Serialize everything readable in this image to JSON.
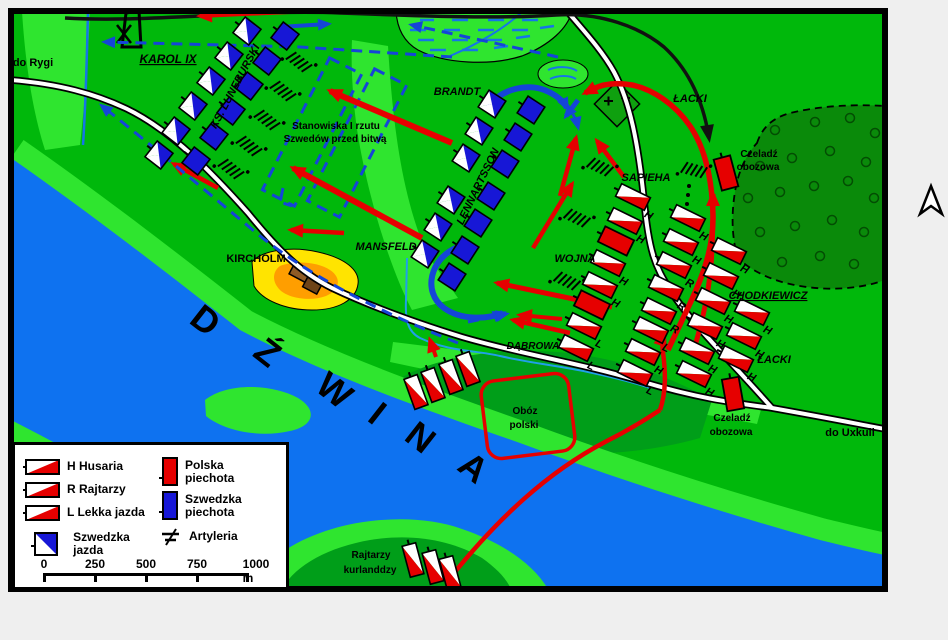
{
  "colors": {
    "land": "#00B80B",
    "land_light": "#2FE52F",
    "land_medium": "#009E19",
    "forest": "#0A8A0A",
    "river": "#0E72F0",
    "polish_red": "#E60000",
    "swedish_blue": "#1717D6",
    "arrow_blue": "#1545D8",
    "hill_yellow": "#FFE400",
    "hill_orange": "#FF9E00",
    "building_brown": "#8F5B25"
  },
  "map_labels": [
    {
      "id": "do-rygi",
      "text": "do Rygi",
      "x": 33,
      "y": 66,
      "size": 11
    },
    {
      "id": "karol-ix",
      "text": "KAROL IX",
      "x": 168,
      "y": 63,
      "size": 12,
      "italic": true,
      "underline": true
    },
    {
      "id": "ks-luneburski",
      "text": "KS. LUNEBURSKI",
      "x": 238,
      "y": 88,
      "size": 11,
      "italic": true,
      "rot": -62
    },
    {
      "id": "brandt",
      "text": "BRANDT",
      "x": 457,
      "y": 95,
      "size": 11,
      "italic": true
    },
    {
      "id": "stanowiska-1",
      "text": "Stanowiska I rzutu",
      "x": 336,
      "y": 129,
      "size": 10
    },
    {
      "id": "stanowiska-2",
      "text": "Szwedów przed bitwą",
      "x": 335,
      "y": 142,
      "size": 10
    },
    {
      "id": "lennartsson",
      "text": "LENNARTSSON",
      "x": 481,
      "y": 188,
      "size": 11,
      "italic": true,
      "rot": -64
    },
    {
      "id": "mansfeld",
      "text": "MANSFELD",
      "x": 386,
      "y": 250,
      "size": 11,
      "italic": true
    },
    {
      "id": "kircholm",
      "text": "KIRCHOLM",
      "x": 256,
      "y": 262,
      "size": 11
    },
    {
      "id": "wojna",
      "text": "WOJNA",
      "x": 575,
      "y": 262,
      "size": 11,
      "italic": true
    },
    {
      "id": "sapieha",
      "text": "SAPIEHA",
      "x": 646,
      "y": 181,
      "size": 11,
      "italic": true
    },
    {
      "id": "lacki-north",
      "text": "ŁACKI",
      "x": 690,
      "y": 102,
      "size": 11,
      "italic": true
    },
    {
      "id": "czeladz-n-1",
      "text": "Czeladź",
      "x": 759,
      "y": 157,
      "size": 10
    },
    {
      "id": "czeladz-n-2",
      "text": "obozowa",
      "x": 758,
      "y": 170,
      "size": 10
    },
    {
      "id": "chodkiewicz",
      "text": "CHODKIEWICZ",
      "x": 768,
      "y": 299,
      "size": 11,
      "italic": true,
      "underline": true
    },
    {
      "id": "lacki-east",
      "text": "ŁACKI",
      "x": 774,
      "y": 363,
      "size": 11,
      "italic": true
    },
    {
      "id": "dabrowa",
      "text": "DĄBROWA",
      "x": 533,
      "y": 349,
      "size": 10,
      "italic": true
    },
    {
      "id": "oboz-1",
      "text": "Obóz",
      "x": 525,
      "y": 414,
      "size": 10
    },
    {
      "id": "oboz-2",
      "text": "polski",
      "x": 524,
      "y": 428,
      "size": 10
    },
    {
      "id": "czeladz-s-1",
      "text": "Czeladź",
      "x": 732,
      "y": 421,
      "size": 10
    },
    {
      "id": "czeladz-s-2",
      "text": "obozowa",
      "x": 731,
      "y": 435,
      "size": 10
    },
    {
      "id": "do-uxkull",
      "text": "do Uxkull",
      "x": 850,
      "y": 436,
      "size": 11
    },
    {
      "id": "rajtarzy-kurlandzcy-1",
      "text": "Rajtarzy",
      "x": 371,
      "y": 558,
      "size": 10
    },
    {
      "id": "rajtarzy-kurlandzcy-2",
      "text": "kurlanddzy",
      "x": 370,
      "y": 573,
      "size": 10
    }
  ],
  "river": {
    "name": "DŹWINA",
    "letters": [
      {
        "ch": "D",
        "x": 198,
        "y": 330
      },
      {
        "ch": "Ź",
        "x": 260,
        "y": 362
      },
      {
        "ch": "W",
        "x": 327,
        "y": 400
      },
      {
        "ch": "I",
        "x": 370,
        "y": 423
      },
      {
        "ch": "N",
        "x": 413,
        "y": 447
      },
      {
        "ch": "A",
        "x": 466,
        "y": 477
      }
    ],
    "rot": 38
  },
  "units": [
    {
      "t": "sc",
      "x": 247,
      "y": 31,
      "r": 38
    },
    {
      "t": "sc",
      "x": 229,
      "y": 56,
      "r": 38
    },
    {
      "t": "sc",
      "x": 211,
      "y": 81,
      "r": 38
    },
    {
      "t": "sc",
      "x": 193,
      "y": 106,
      "r": 38
    },
    {
      "t": "sc",
      "x": 176,
      "y": 131,
      "r": 38
    },
    {
      "t": "sc",
      "x": 159,
      "y": 155,
      "r": 38
    },
    {
      "t": "si",
      "x": 285,
      "y": 36,
      "r": 38
    },
    {
      "t": "si",
      "x": 267,
      "y": 61,
      "r": 38
    },
    {
      "t": "si",
      "x": 249,
      "y": 86,
      "r": 38
    },
    {
      "t": "si",
      "x": 231,
      "y": 111,
      "r": 38
    },
    {
      "t": "si",
      "x": 214,
      "y": 136,
      "r": 38
    },
    {
      "t": "si",
      "x": 196,
      "y": 161,
      "r": 38
    },
    {
      "t": "sc",
      "x": 492,
      "y": 104,
      "r": 33
    },
    {
      "t": "sc",
      "x": 479,
      "y": 131,
      "r": 33
    },
    {
      "t": "sc",
      "x": 466,
      "y": 158,
      "r": 33
    },
    {
      "t": "sc",
      "x": 451,
      "y": 200,
      "r": 33
    },
    {
      "t": "sc",
      "x": 438,
      "y": 227,
      "r": 33
    },
    {
      "t": "sc",
      "x": 425,
      "y": 254,
      "r": 33
    },
    {
      "t": "si",
      "x": 531,
      "y": 110,
      "r": 33
    },
    {
      "t": "si",
      "x": 518,
      "y": 137,
      "r": 33
    },
    {
      "t": "si",
      "x": 505,
      "y": 164,
      "r": 33
    },
    {
      "t": "si",
      "x": 491,
      "y": 196,
      "r": 33
    },
    {
      "t": "si",
      "x": 478,
      "y": 223,
      "r": 33
    },
    {
      "t": "si",
      "x": 465,
      "y": 250,
      "r": 33
    },
    {
      "t": "si",
      "x": 452,
      "y": 277,
      "r": 33
    },
    {
      "t": "pc",
      "x": 633,
      "y": 197,
      "r": 26,
      "tag": "H"
    },
    {
      "t": "pc",
      "x": 625,
      "y": 221,
      "r": 26,
      "tag": "H"
    },
    {
      "t": "pi",
      "x": 616,
      "y": 241,
      "r": 26
    },
    {
      "t": "pc",
      "x": 608,
      "y": 263,
      "r": 26,
      "tag": "H"
    },
    {
      "t": "pc",
      "x": 600,
      "y": 285,
      "r": 26,
      "tag": "H"
    },
    {
      "t": "pi",
      "x": 592,
      "y": 305,
      "r": 26
    },
    {
      "t": "pc",
      "x": 584,
      "y": 326,
      "r": 26,
      "tag": "L"
    },
    {
      "t": "pc",
      "x": 576,
      "y": 348,
      "r": 26,
      "tag": "L"
    },
    {
      "t": "pc",
      "x": 688,
      "y": 218,
      "r": 26,
      "tag": "H"
    },
    {
      "t": "pc",
      "x": 681,
      "y": 242,
      "r": 26,
      "tag": "H"
    },
    {
      "t": "pc",
      "x": 674,
      "y": 265,
      "r": 26,
      "tag": "R"
    },
    {
      "t": "pc",
      "x": 666,
      "y": 288,
      "r": 26,
      "tag": "R"
    },
    {
      "t": "pc",
      "x": 659,
      "y": 311,
      "r": 26,
      "tag": "R"
    },
    {
      "t": "pc",
      "x": 651,
      "y": 330,
      "r": 26,
      "tag": "L"
    },
    {
      "t": "pc",
      "x": 643,
      "y": 352,
      "r": 26,
      "tag": "H"
    },
    {
      "t": "pc",
      "x": 635,
      "y": 373,
      "r": 26,
      "tag": "L"
    },
    {
      "t": "pc",
      "x": 729,
      "y": 251,
      "r": 26,
      "tag": "H"
    },
    {
      "t": "pc",
      "x": 721,
      "y": 276,
      "r": 26,
      "tag": "H"
    },
    {
      "t": "pc",
      "x": 713,
      "y": 301,
      "r": 26,
      "tag": "H"
    },
    {
      "t": "pc",
      "x": 705,
      "y": 326,
      "r": 26,
      "tag": "H"
    },
    {
      "t": "pc",
      "x": 697,
      "y": 351,
      "r": 26,
      "tag": "H"
    },
    {
      "t": "pc",
      "x": 752,
      "y": 312,
      "r": 26,
      "tag": "H"
    },
    {
      "t": "pc",
      "x": 744,
      "y": 336,
      "r": 26,
      "tag": "H"
    },
    {
      "t": "pc",
      "x": 736,
      "y": 359,
      "r": 26,
      "tag": "H"
    },
    {
      "t": "pc",
      "x": 694,
      "y": 374,
      "r": 26,
      "tag": "H"
    },
    {
      "t": "pc",
      "x": 416,
      "y": 392,
      "r": 70
    },
    {
      "t": "pc",
      "x": 433,
      "y": 385,
      "r": 70
    },
    {
      "t": "pc",
      "x": 451,
      "y": 377,
      "r": 70
    },
    {
      "t": "pc",
      "x": 468,
      "y": 369,
      "r": 70
    },
    {
      "t": "pc",
      "x": 413,
      "y": 560,
      "r": 75
    },
    {
      "t": "pc",
      "x": 433,
      "y": 567,
      "r": 75
    },
    {
      "t": "pc",
      "x": 450,
      "y": 573,
      "r": 75
    },
    {
      "t": "pi",
      "x": 726,
      "y": 173,
      "r": 75
    },
    {
      "t": "pi",
      "x": 733,
      "y": 394,
      "r": 80
    }
  ],
  "artillery": [
    {
      "x": 299,
      "y": 62,
      "r": 38
    },
    {
      "x": 283,
      "y": 91,
      "r": 38
    },
    {
      "x": 267,
      "y": 120,
      "r": 38
    },
    {
      "x": 249,
      "y": 146,
      "r": 38
    },
    {
      "x": 231,
      "y": 169,
      "r": 38
    },
    {
      "x": 600,
      "y": 167,
      "r": 26
    },
    {
      "x": 577,
      "y": 218,
      "r": 26
    },
    {
      "x": 567,
      "y": 281,
      "r": 26
    },
    {
      "x": 694,
      "y": 170,
      "r": 15
    }
  ],
  "legend": {
    "cavalry": [
      {
        "tag": "H",
        "label": "Husaria"
      },
      {
        "tag": "R",
        "label": "Rajtarzy"
      },
      {
        "tag": "L",
        "label": "Lekka jazda"
      }
    ],
    "swedish_cavalry_label": "Szwedzka jazda",
    "polish_infantry_label": "Polska piechota",
    "swedish_infantry_label": "Szwedzka piechota",
    "artillery_label": "Artyleria"
  },
  "scale_bar": {
    "labels": [
      "0",
      "250",
      "500",
      "750",
      "1000 m"
    ]
  }
}
